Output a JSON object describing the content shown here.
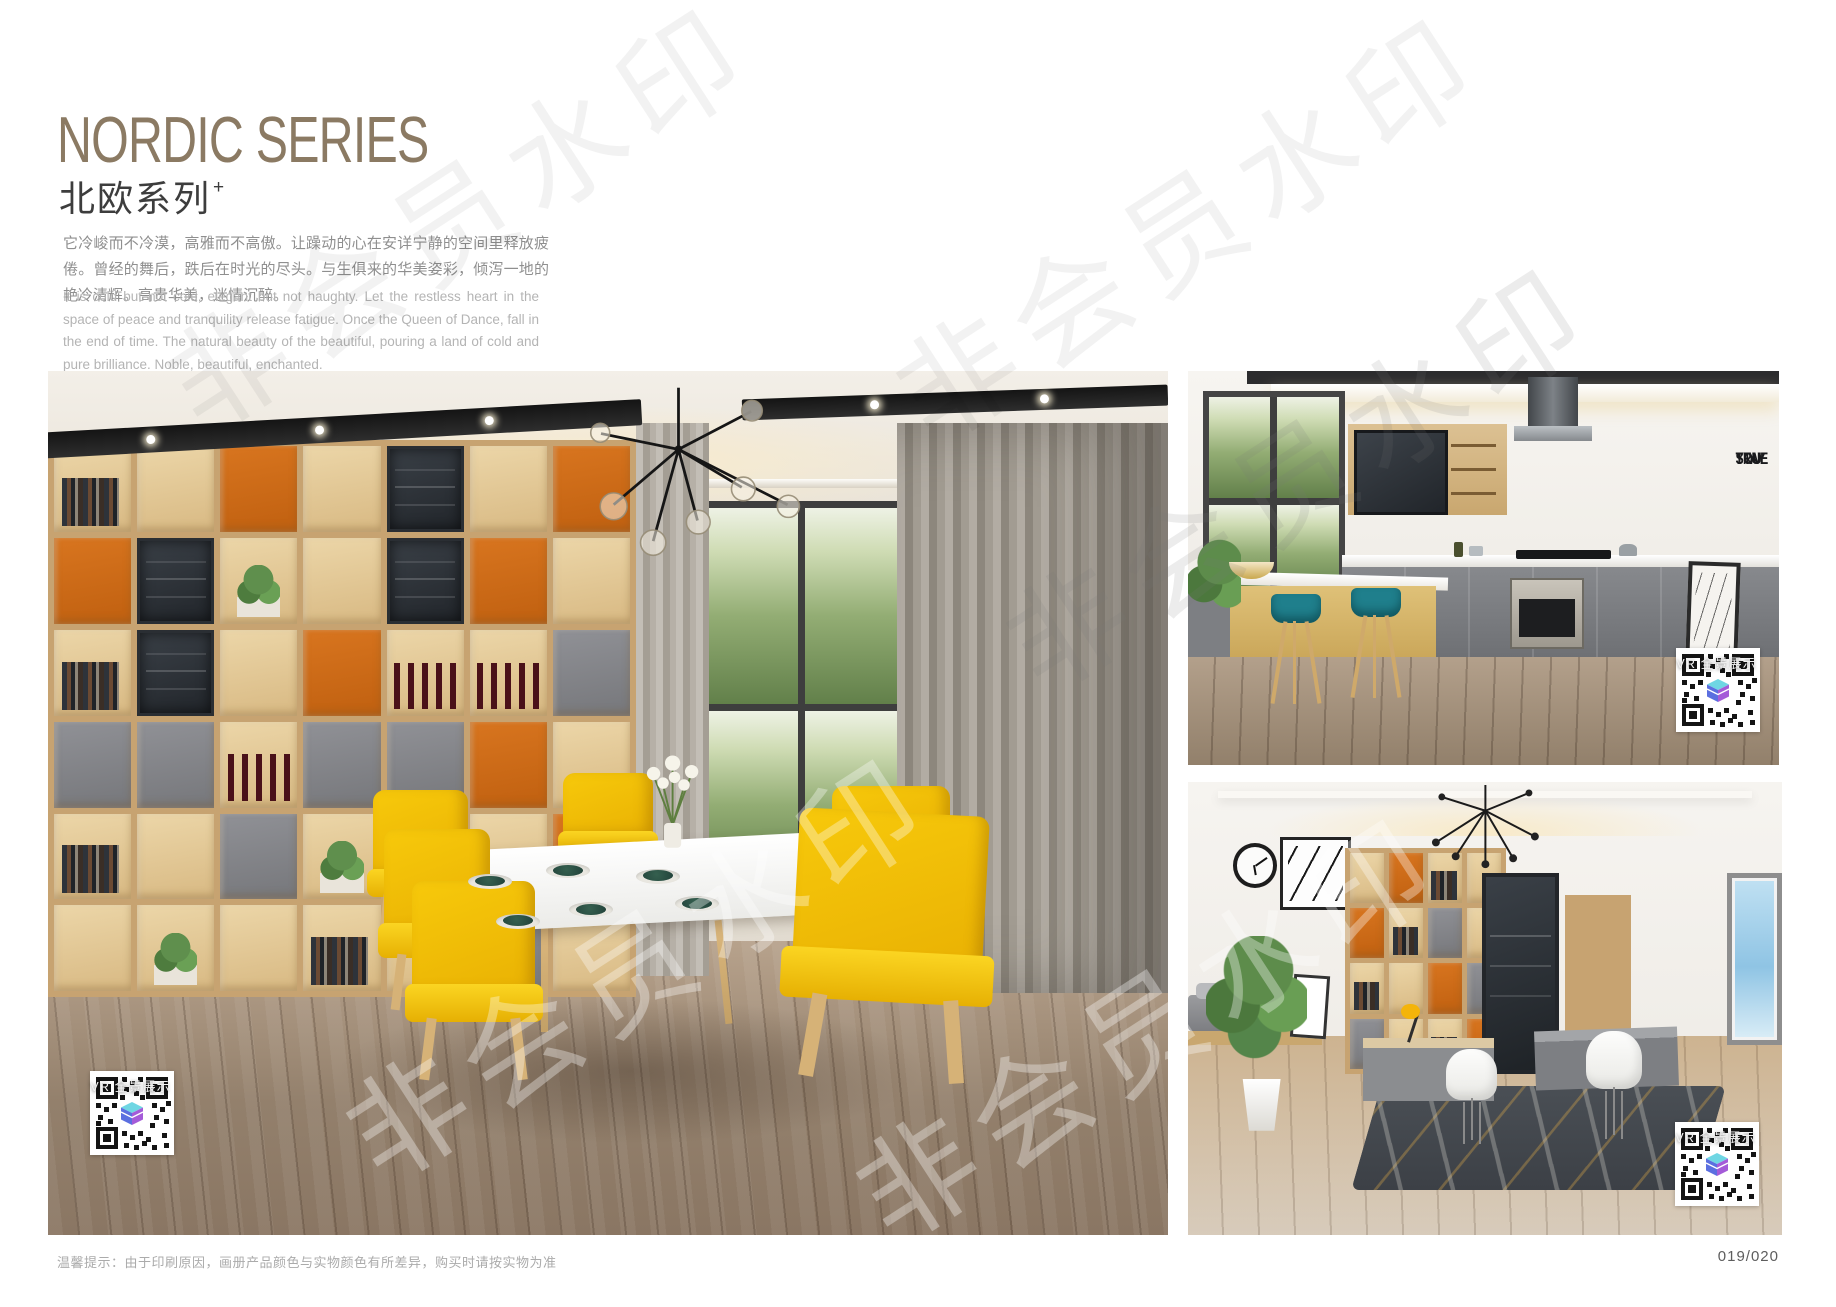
{
  "header": {
    "title": "NORDIC SERIES",
    "subtitle": "北欧系列",
    "subtitle_superscript": "+",
    "intro_cn": "它冷峻而不冷漠，高雅而不高傲。让躁动的心在安详宁静的空间里释放疲倦。曾经的舞后，跌后在时光的尽头。与生俱来的华美姿彩，倾泻一地的艳冷清辉。高贵华美，迷情沉醉。",
    "intro_en": "It is cold but not cold, elegant but not haughty. Let the restless heart in the space of peace and tranquility release fatigue. Once the Queen of Dance, fall in the end of time. The natural beauty of the beautiful, pouring a land of cold and pure brilliance. Noble, beautiful, enchanted."
  },
  "photos": {
    "kitchen": {
      "wall_art_lines": [
        "STAY",
        "TRUE",
        "STAY",
        "YOU"
      ]
    }
  },
  "vr_badge": {
    "label": "VR 全景展示"
  },
  "watermark": {
    "text": "非会员水印"
  },
  "footer": {
    "note": "温馨提示：由于印刷原因，画册产品颜色与实物颜色有所差异，购买时请按实物为准",
    "page_number": "019/020"
  },
  "colors": {
    "title": "#8b7a63",
    "chair_yellow": "#f7c90b",
    "shelf_orange": "#d8751f",
    "stool_teal": "#1f7f8c",
    "lamp_yellow": "#f4b40a"
  }
}
